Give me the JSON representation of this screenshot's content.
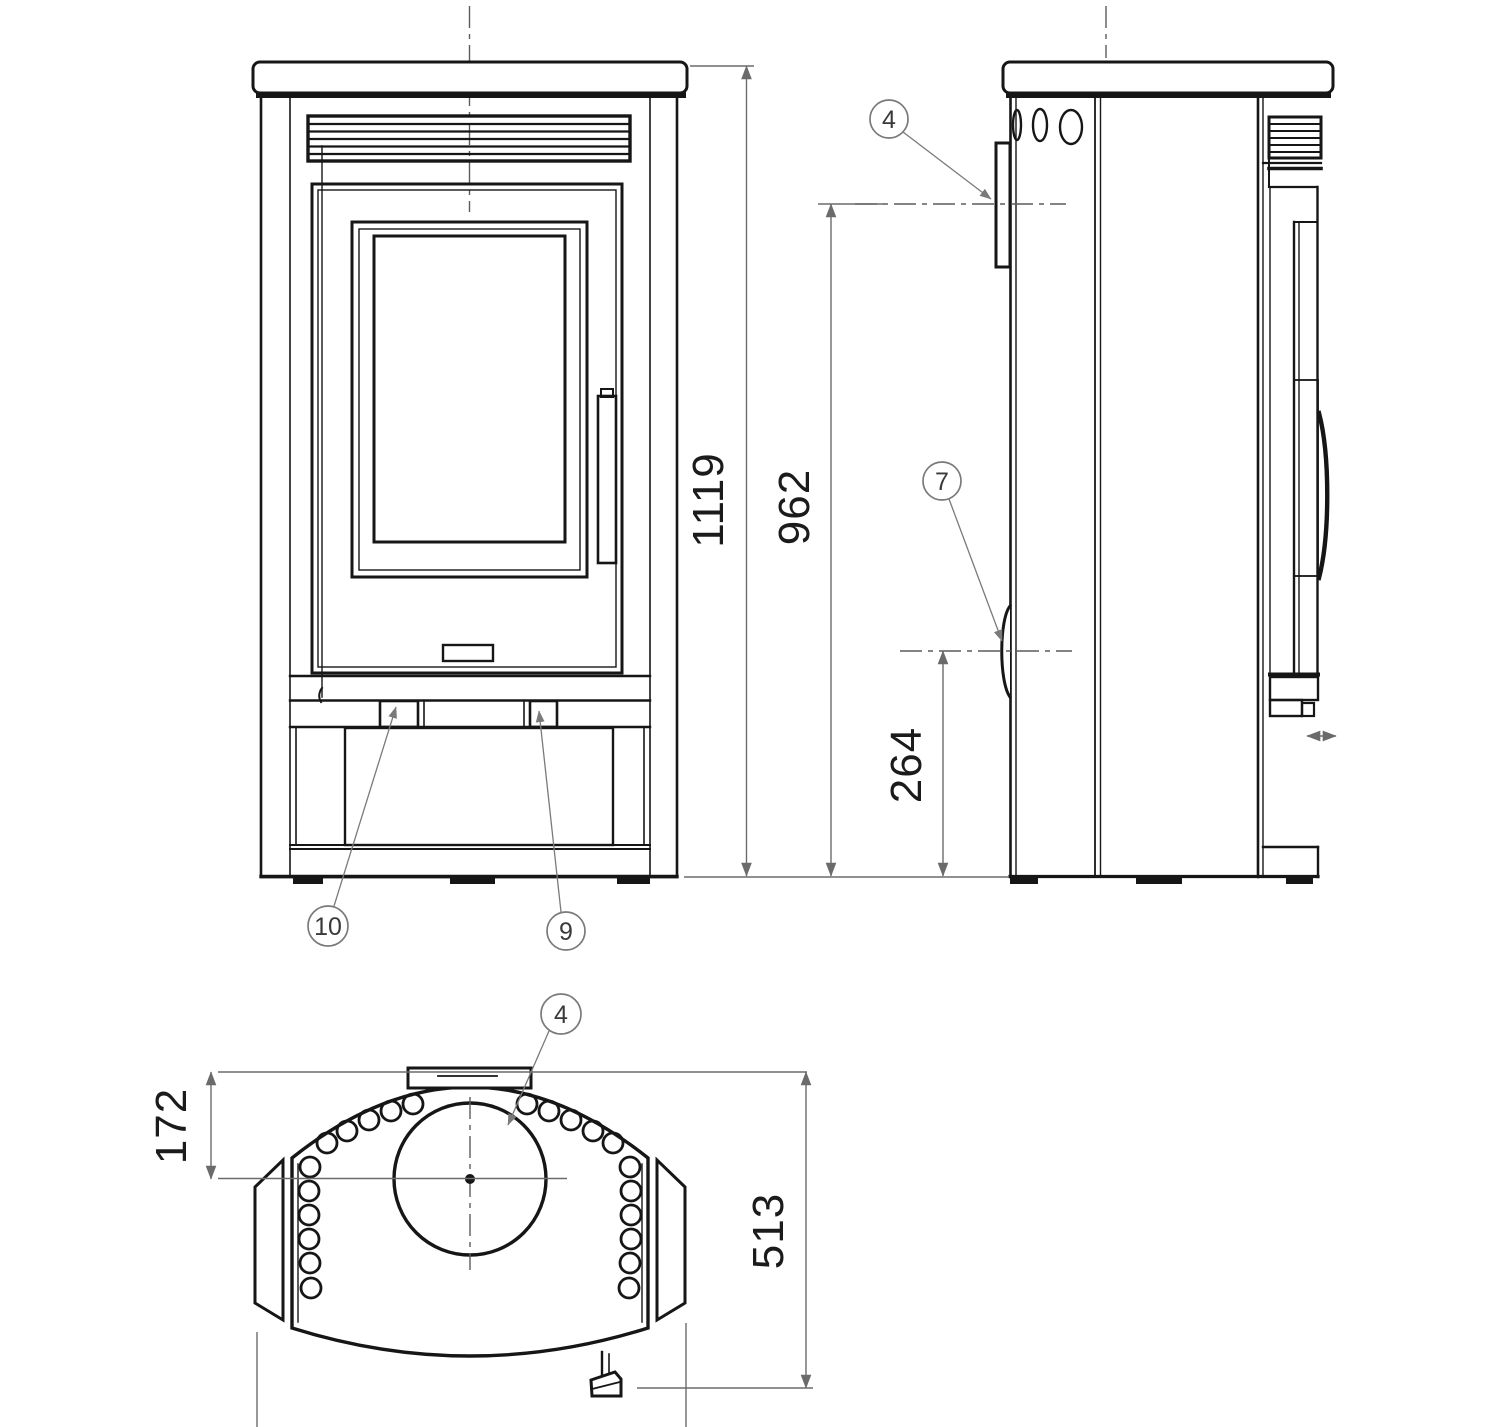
{
  "drawing": {
    "dims": {
      "overall_height": "1119",
      "rear_flue_height": "962",
      "lower_connection_height": "264",
      "flue_offset_from_back": "172",
      "depth": "513"
    },
    "callouts": {
      "side_flue_collar": "4",
      "rear_connection": "7",
      "plinth_button_right": "9",
      "plinth_button_left": "10",
      "top_flue_collar": "4"
    }
  }
}
